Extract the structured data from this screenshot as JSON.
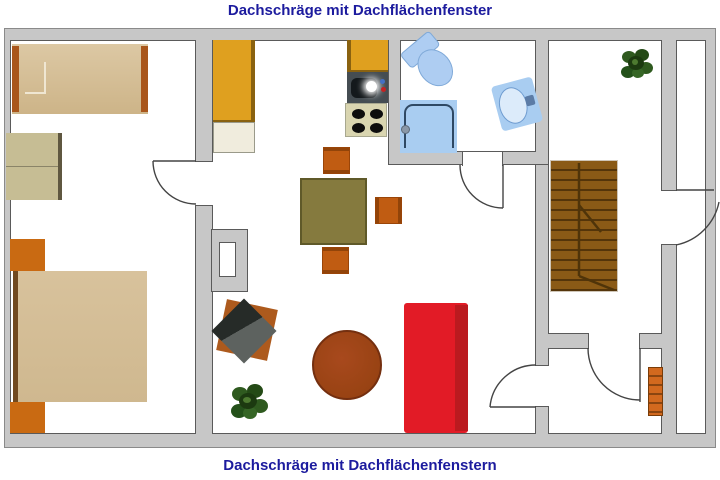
{
  "titles": {
    "top": "Dachschräge mit Dachflächenfenster",
    "bottom": "Dachschräge mit Dachflächenfenstern"
  },
  "colors": {
    "title_text": "#1c1b9e",
    "wall_fill": "#c7c7c7",
    "wall_outline": "#5a5a5a",
    "floor": "#ffffff",
    "cabinet_yellow": "#dfa01f",
    "counter_cream": "#f0ecdd",
    "furniture_orange": "#c96a12",
    "bed_tan": "#d8c29c",
    "wardrobe_khaki": "#c6bd94",
    "dining_table_olive": "#857a3e",
    "sofa_red": "#e21b26",
    "sofa_red_dark": "#bb1a1f",
    "coffee_table_rust": "#a8491d",
    "stairs_brown": "#8a5a16",
    "bath_fixture_blue": "#a9cdf1",
    "plant_green": "#2f5a1f",
    "tv_dark_gray": "#2e3330",
    "radiator_orange": "#d2691e"
  },
  "floor_plan": {
    "rooms": [
      "bedroom",
      "kitchen-living-room",
      "bathroom",
      "stair-hall",
      "storage-room",
      "side-corridor"
    ],
    "door_count": 5,
    "furniture": [
      "single-bed",
      "wardrobe",
      "nightstand-top",
      "double-bed",
      "nightstand-bottom",
      "kitchen-tall-cabinet",
      "kitchen-counter",
      "kitchen-upper-cabinet",
      "kitchen-sink",
      "stove",
      "dining-table",
      "dining-chair-top",
      "dining-chair-right",
      "dining-chair-bottom",
      "tv-stand",
      "tv",
      "potted-plant-living",
      "round-coffee-table",
      "sofa",
      "toilet",
      "shower",
      "washbasin",
      "staircase",
      "potted-plant-hall",
      "radiator",
      "chimney"
    ]
  }
}
